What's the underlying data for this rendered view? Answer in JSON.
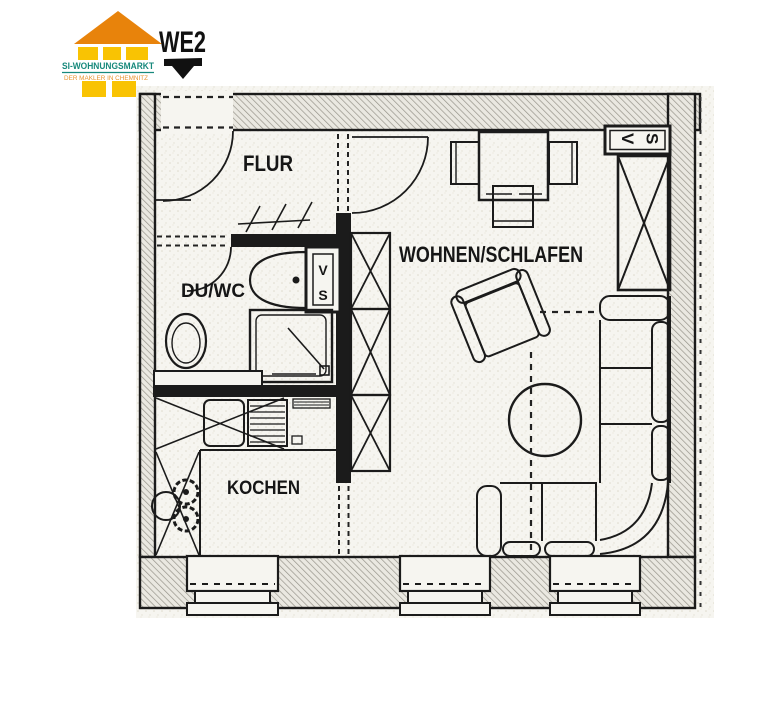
{
  "logo": {
    "brand": "SI-WOHNUNGSMARKT",
    "tagline": "DER MAKLER IN CHEMNITZ",
    "colors": {
      "roof": "#e8830b",
      "wall": "#f9c303",
      "brand_text": "#17897c",
      "tagline_text": "#e8932d"
    }
  },
  "annotation": {
    "unit_label": "WE2"
  },
  "floorplan": {
    "rooms": [
      {
        "id": "flur",
        "label": "FLUR"
      },
      {
        "id": "du_wc",
        "label": "DU/WC"
      },
      {
        "id": "wohnen_schlafen",
        "label": "WOHNEN/SCHLAFEN"
      },
      {
        "id": "kochen",
        "label": "KOCHEN"
      }
    ],
    "shafts": {
      "bath_shaft_line1": "V",
      "bath_shaft_line2": "S",
      "hall_shaft": "VS"
    },
    "ink": "#1b1b1b"
  }
}
